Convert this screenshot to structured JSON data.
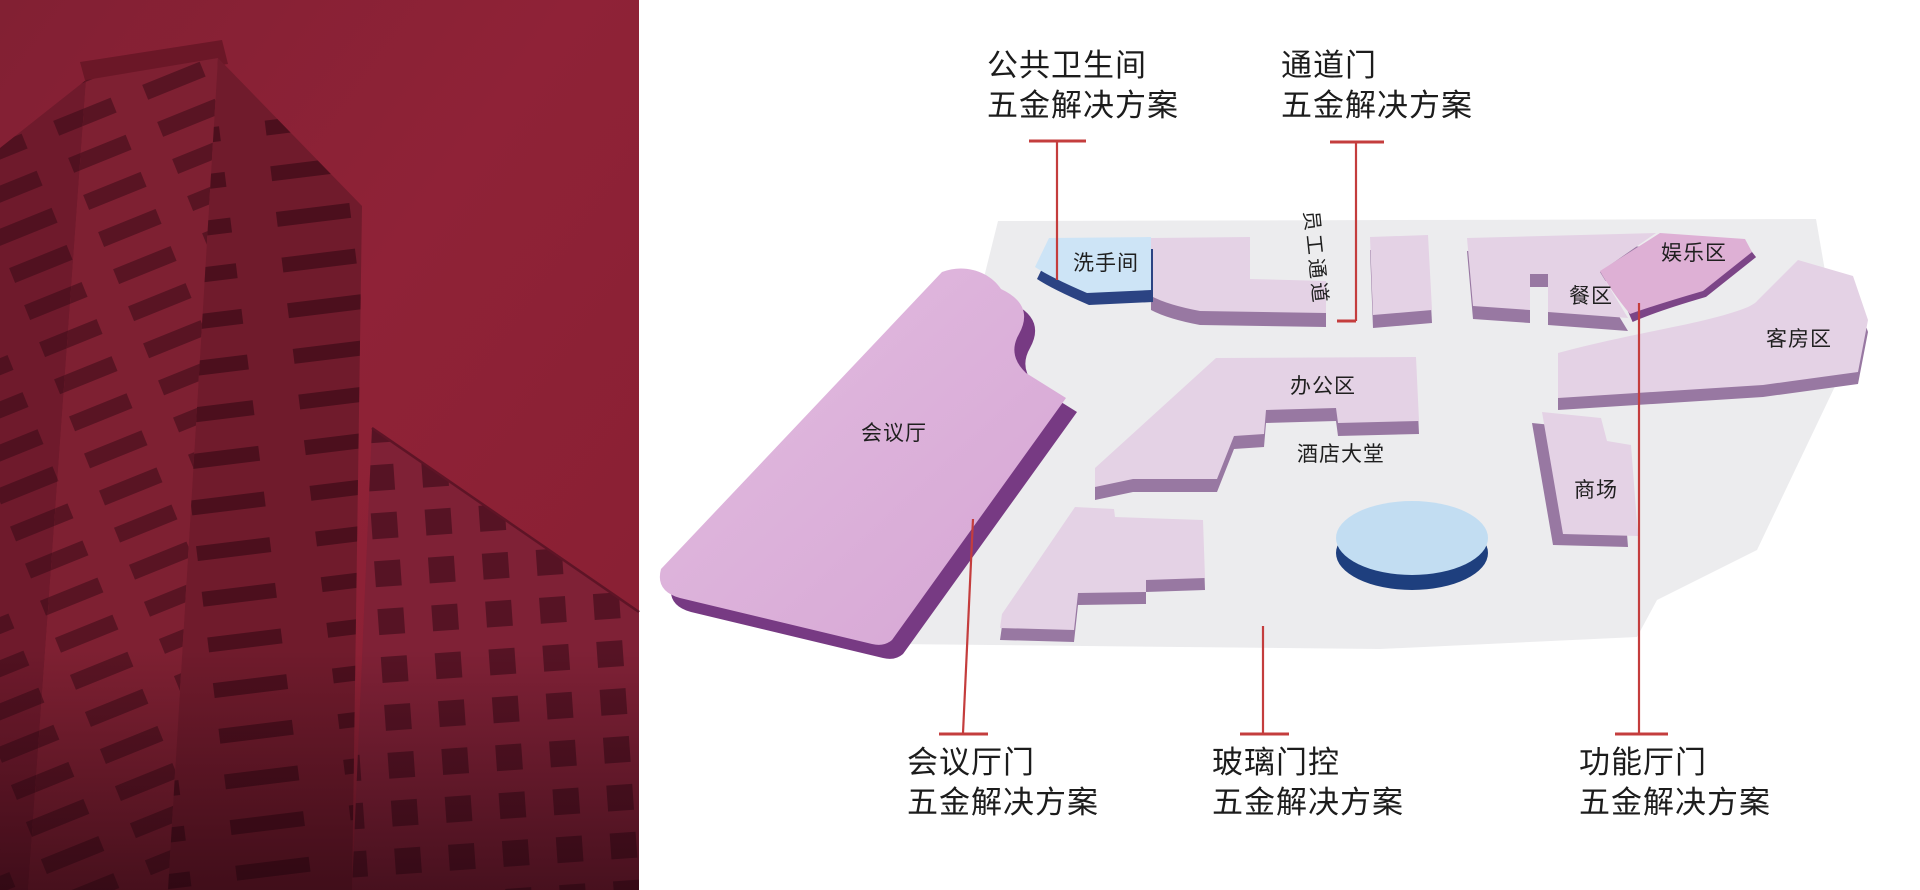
{
  "canvas": {
    "width": 1920,
    "height": 890
  },
  "photo_panel": {
    "name": "building-photo"
  },
  "map": {
    "areas": [
      {
        "id": "washroom",
        "label": "洗手间"
      },
      {
        "id": "staff-passage",
        "label": "员工通道"
      },
      {
        "id": "entertainment-zone",
        "label": "娱乐区"
      },
      {
        "id": "dining-zone",
        "label": "餐区"
      },
      {
        "id": "guest-room-zone",
        "label": "客房区"
      },
      {
        "id": "office-zone",
        "label": "办公区"
      },
      {
        "id": "hotel-lobby",
        "label": "酒店大堂"
      },
      {
        "id": "mall",
        "label": "商场"
      },
      {
        "id": "conference-hall",
        "label": "会议厅"
      }
    ]
  },
  "callouts": [
    {
      "id": "public-restroom-hardware",
      "line1": "公共卫生间",
      "line2": "五金解决方案"
    },
    {
      "id": "passage-door-hardware",
      "line1": "通道门",
      "line2": "五金解决方案"
    },
    {
      "id": "conference-hall-door-hardware",
      "line1": "会议厅门",
      "line2": "五金解决方案"
    },
    {
      "id": "glass-door-control-hardware",
      "line1": "玻璃门控",
      "line2": "五金解决方案"
    },
    {
      "id": "function-hall-door-hardware",
      "line1": "功能厅门",
      "line2": "五金解决方案"
    }
  ],
  "colors": {
    "accent_red": "#c43d3d",
    "photo_crimson": "#8d2136",
    "floor": "#ececee",
    "block_face": "#e4d2e5",
    "block_side": "#9878a2",
    "conference_face": "#dcb1da",
    "conference_side": "#773a83",
    "entertainment_face": "#deb0d5",
    "entertainment_side": "#7c4587",
    "washroom_face": "#cde4f6",
    "washroom_side": "#2b4383",
    "fountain_face": "#c2ddf2",
    "fountain_side": "#1e3f7e",
    "label_text": "#1c1c1c"
  }
}
